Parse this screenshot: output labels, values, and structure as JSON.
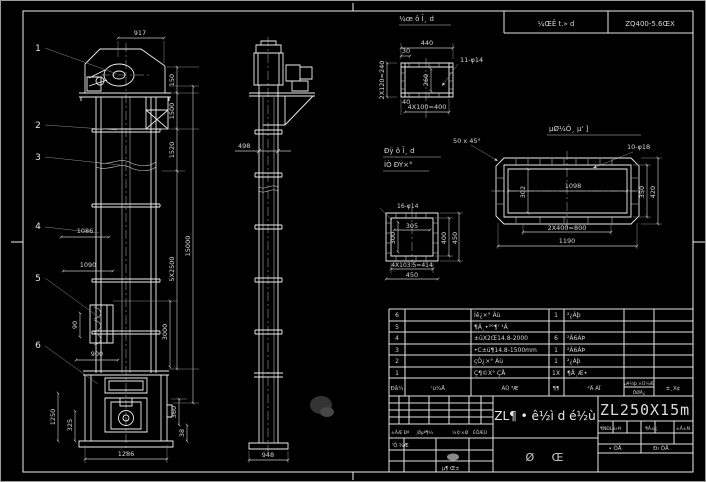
{
  "top_notes": {
    "left_cell": "¼ŒÊ t.» d",
    "right_cell": "ZQ400-5.6ŒX"
  },
  "balloons": [
    "1",
    "2",
    "3",
    "4",
    "5",
    "6"
  ],
  "front": {
    "d917": "917",
    "d150": "150",
    "d1500": "1500",
    "d1520": "1520",
    "d5x2500": "5X2500",
    "d15000": "15000",
    "d3000": "3000",
    "d360": "360",
    "d38": "38",
    "d1086": "1086",
    "d1090": "1090",
    "d90": "90",
    "d900": "900",
    "d1250": "1250",
    "d325": "325",
    "d1286": "1286"
  },
  "side": {
    "d498": "498",
    "d948": "948"
  },
  "inlet": {
    "title": "¼œ ô Ī¸ d",
    "d440": "440",
    "d30": "30",
    "d2x120": "2X120=240",
    "d260": "260",
    "holes": "11-φ14",
    "d40": "40",
    "d4x100": "4X100=400"
  },
  "outlet": {
    "title": "µØ¼Ò¸ µ' ]",
    "chamfer": "50 x 45°",
    "holes": "10-φ18",
    "d1098": "1098",
    "d302": "302",
    "d350": "350",
    "d420": "420",
    "d2x400": "2X400=800",
    "d1190": "1190"
  },
  "square": {
    "title1": "Ðÿ ô Ī¸ d",
    "title2": "ÍÒ ÐÝ×°",
    "holes": "16-φ14",
    "d305": "305",
    "d300": "300",
    "d400": "400",
    "d450r": "450",
    "d4x103": "4X103.5=414",
    "d450b": "450"
  },
  "bom": {
    "rows": [
      {
        "no": "6",
        "name": "Íê¿×° Áù",
        "qty": "1",
        "mat": "²¿Áþ"
      },
      {
        "no": "5",
        "name": "¶Ä¸•³°¶' ¹Ä",
        "qty": "",
        "mat": ""
      },
      {
        "no": "4",
        "name": "±üX2Œ14.8-2000",
        "qty": "6",
        "mat": "²Ä6ÁÞ"
      },
      {
        "no": "3",
        "name": "•C±ü¶14.8-1500mm",
        "qty": "1",
        "mat": "²Ä6ÁÞ"
      },
      {
        "no": "2",
        "name": "çÒ¿×° Áù",
        "qty": "1",
        "mat": "²¿Áþ"
      },
      {
        "no": "1",
        "name": "Ç¶©X° ÇÅ",
        "qty": "1X",
        "mat": "¶Å¸Æ•"
      }
    ],
    "headers": {
      "no": "Ðå¼",
      "dwg": "'ü¼Å",
      "name": "ÃÛ ³Æ",
      "qty": "¶¶",
      "mat": "²Ä ÁÏ",
      "wt1": "µ¥¼þ ×Ü¼Æ",
      "wt2": "ÖØÁ¿",
      "rem": "±¸X¢"
    }
  },
  "titleblock": {
    "title": "ZL¶ • ê½ì d é½ù",
    "dwg_no": "ZL250X15m",
    "sheet_label": "Ø Œ",
    "rev_headers": {
      "h1": "±ÅÆ Ðª",
      "h2": "¸Øµª¶¼",
      "h3": "¼©×Ø",
      "h4": "ÈÕÆÚ"
    },
    "design": "'Ò ¾Æ",
    "date": "µ¶ Œ±",
    "stage": {
      "s1": "¶ÑÐL±ıĦ",
      "s2": "¶Å±ç",
      "s3": "±Å±Ñ"
    },
    "sheets": {
      "total": "• ÕÅ",
      "page": "Ðı ÕÅ"
    }
  }
}
